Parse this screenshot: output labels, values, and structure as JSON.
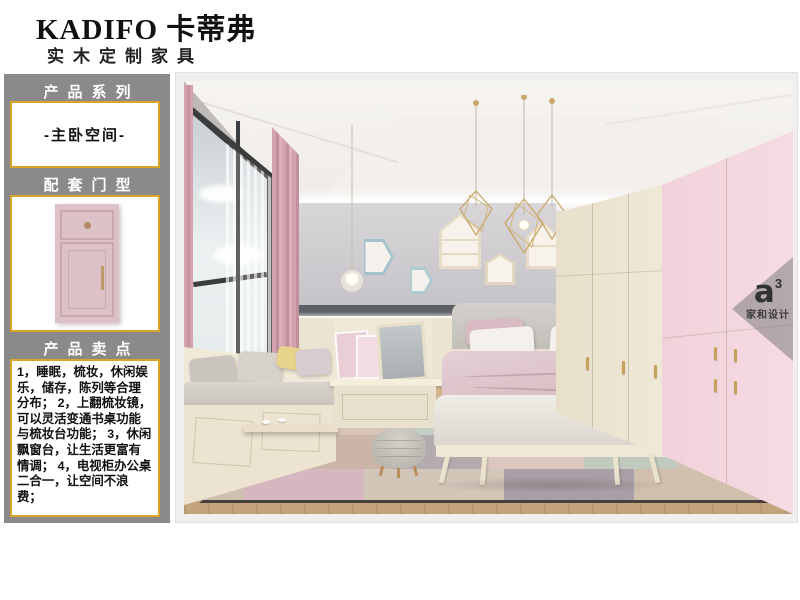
{
  "brand": {
    "name": "KADIFO 卡蒂弗",
    "tagline": "实木定制家具"
  },
  "sidebar": {
    "series_title": "产品系列",
    "series_value": "-主卧空间-",
    "door_title": "配套门型",
    "selling_title": "产品卖点",
    "selling_points": [
      "1，睡眠，梳妆，休闲娱乐，储存，陈列等合理分布；",
      "2，上翻梳妆镜，可以灵活变通书桌功能与梳妆台功能；",
      "3，休闲飘窗台，让生活更富有情调；",
      "4，电视柜办公桌二合一，让空间不浪费；"
    ]
  },
  "watermark": {
    "logo": "a",
    "logo_sup": "3",
    "caption": "家和设计"
  },
  "colors": {
    "accent_gold": "#d9a428",
    "sidebar_gray": "#8a8a8a",
    "door_pink": "#dcc2c7",
    "wardrobe_pink": "#f4d8df",
    "wardrobe_cream": "#ece5d2",
    "wall_gray": "#c9c7cb",
    "stripe_dark": "#5d6065"
  }
}
